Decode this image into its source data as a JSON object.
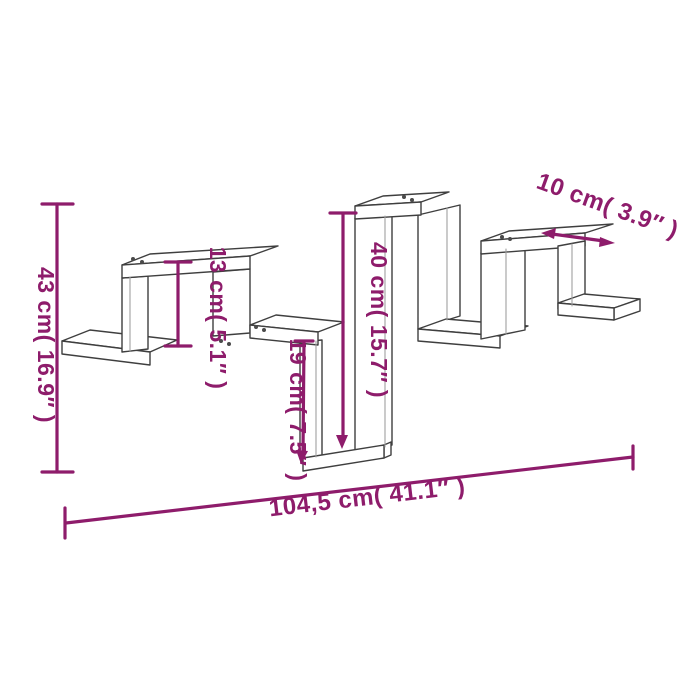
{
  "diagram": {
    "colors": {
      "annotation": "#8e1c6b",
      "outline": "#3f3f3f",
      "outline_light": "#a0a0a0",
      "background": "#ffffff"
    },
    "dimensions": {
      "overall_height": {
        "label": "43 cm( 16.9″ )",
        "value_cm": "43",
        "value_inch": "16.9"
      },
      "box_height": {
        "label": "13 cm( 5.1″ )",
        "value_cm": "13",
        "value_inch": "5.1"
      },
      "drop_height": {
        "label": "19 cm( 7.5″ )",
        "value_cm": "19",
        "value_inch": "7.5"
      },
      "column_height": {
        "label": "40 cm( 15.7″ )",
        "value_cm": "40",
        "value_inch": "15.7"
      },
      "shelf_depth": {
        "label": "10 cm( 3.9″ )",
        "value_cm": "10",
        "value_inch": "3.9"
      },
      "overall_width": {
        "label": "104,5 cm( 41.1″ )",
        "value_cm": "104,5",
        "value_inch": "41.1"
      }
    }
  }
}
